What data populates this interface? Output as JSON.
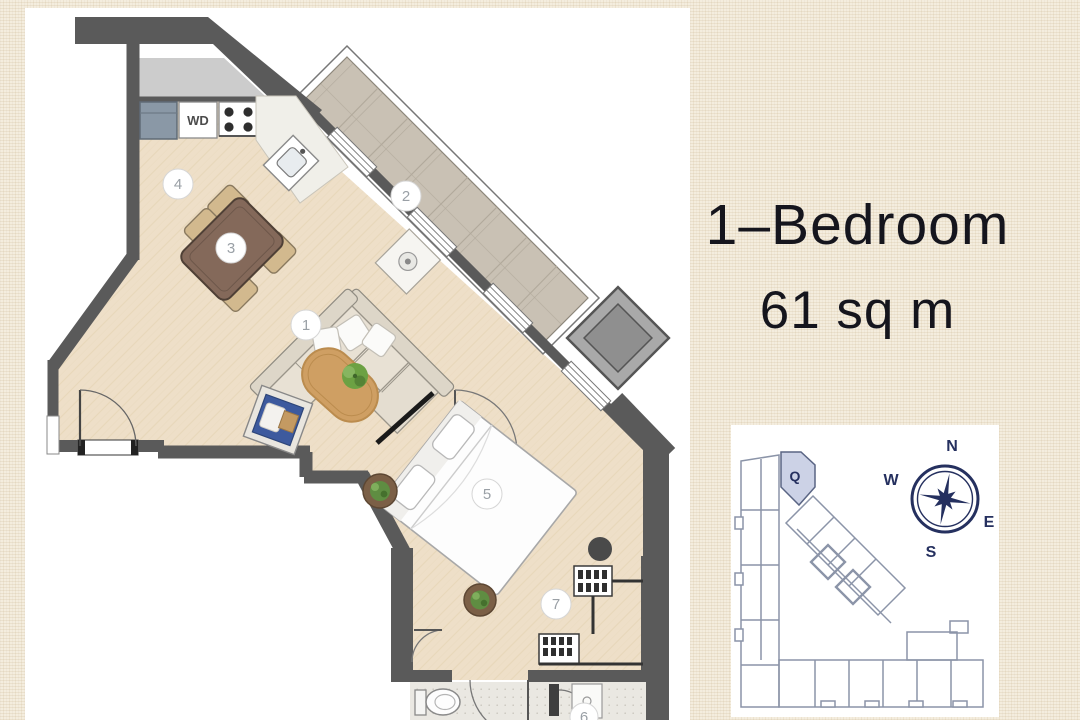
{
  "header": {
    "title_line1": "1–Bedroom",
    "title_line2": "61 sq m"
  },
  "floor_plan": {
    "appliance_label": "WD",
    "markers": {
      "m1": "1",
      "m2": "2",
      "m3": "3",
      "m4": "4",
      "m5": "5",
      "m6": "6",
      "m7": "7"
    }
  },
  "site_map": {
    "unit_label": "Q",
    "compass": {
      "n": "N",
      "e": "E",
      "s": "S",
      "w": "W"
    }
  },
  "colors": {
    "page_background": "#f4edde",
    "plan_background": "#ffffff",
    "wall_dark": "#5a5a5a",
    "terrace_gray": "#cccccc",
    "floor_wood": "#eedfc8",
    "balcony_tile": "#c9c1b4",
    "table_brown": "#84695a",
    "chair_tan": "#d2b98e",
    "armchair_blue": "#3d5a9e",
    "rug_tan": "#cf9f63",
    "plant_green": "#6ca143",
    "marker_text": "#9aa0a6",
    "title_text": "#15151d",
    "compass_navy": "#25305f",
    "sitemap_line": "#8b94a8",
    "unit_highlight": "#ccd2e6"
  }
}
